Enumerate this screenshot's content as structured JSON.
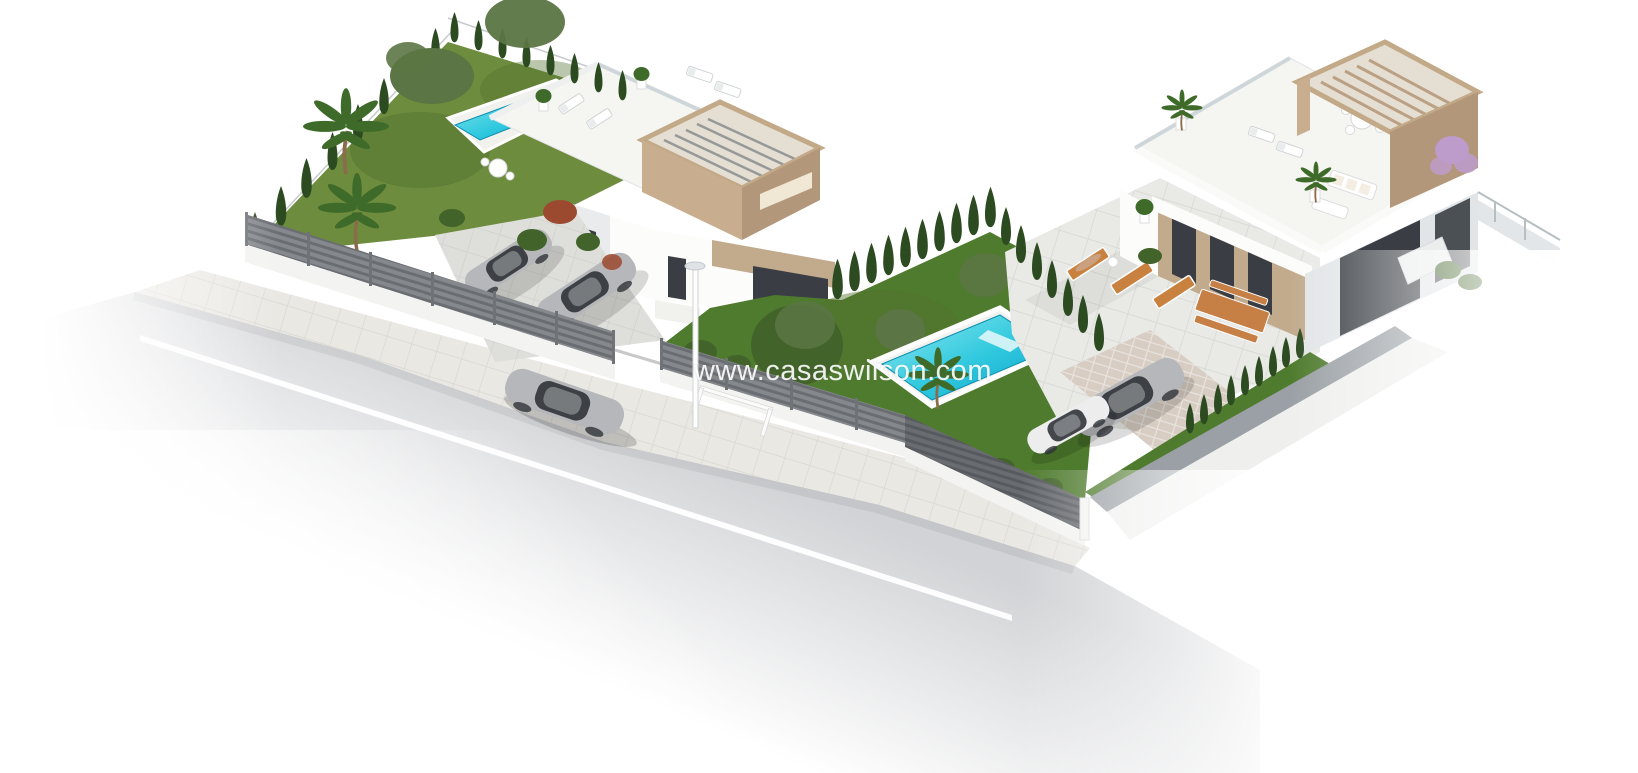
{
  "meta": {
    "type": "3d-architectural-render",
    "subject": "Aerial 3D render of two modern white villas with gardens, swimming pools, pergola roof terraces, parked cars and a street"
  },
  "watermark": {
    "text": "www.casaswilson.com"
  },
  "scene": {
    "left_villa": {
      "label": "left-villa-plot",
      "features": [
        "flat white roof terrace",
        "wood pergola tower",
        "narrow lap pool",
        "large lawn",
        "palm trees",
        "cypress hedge",
        "two parked silver cars",
        "grey slatted street fence"
      ]
    },
    "middle_garden": {
      "label": "garden-with-pool",
      "features": [
        "turquoise swimming pool",
        "lawn",
        "leafy trees",
        "palm tree",
        "cypress hedge"
      ]
    },
    "right_villa": {
      "label": "right-villa-plot",
      "features": [
        "roof terrace with white lounge furniture",
        "wood pergola",
        "paved patio",
        "orange sun loungers",
        "wooden picnic table",
        "driveway with silver and white car",
        "cypress hedges",
        "purple flowering tree"
      ]
    },
    "street": {
      "label": "street",
      "features": [
        "asphalt road",
        "white center line",
        "silver sedan",
        "street lamp",
        "tiled sidewalk"
      ]
    }
  },
  "colors": {
    "bg": "#ffffff",
    "road": "#d2d3d6",
    "road-line": "#ffffff",
    "sidewalk": "#eae8e3",
    "fence": "#85888c",
    "fence-dark": "#696c70",
    "fence-base": "#f3f3f2",
    "wall-gray": "#9aa0a5",
    "grass-left": "#6d8c3e",
    "grass-mid": "#4f7b2e",
    "grass-dark": "#54722f",
    "cypress": "#2d4b21",
    "tree-olive": "#5b7544",
    "tree-blob": "#426329",
    "palm-green": "#3f6b2a",
    "trunk-brown": "#8a6b4a",
    "bush-red": "#9c4a2f",
    "pool-light": "#8fe9f0",
    "pool-mid": "#2ec8de",
    "pool-deep": "#129ec9",
    "pool-deck": "#f1f1ee",
    "villa-white": "#fcfcfb",
    "villa-roof": "#f5f5f2",
    "villa-shade": "#e9ebec",
    "villa-side": "#e2e5e7",
    "window-dark": "#3a3e44",
    "pergola-top": "#e5dfd3",
    "pergola-frame": "#c2a987",
    "pergola-front": "#b3977a",
    "pergola-side": "#c8ae8e",
    "pergola-cut": "#f0e7d4",
    "tan-wall": "#c2ab8d",
    "car-silver": "#b6b7ba",
    "car-white": "#ededee",
    "car-glass": "#30343a",
    "lounger-orange": "#c8813f",
    "wood-brown": "#c67f45",
    "purple-tree": "#bd9bca",
    "lamp-white": "#fdfdfd",
    "watermark-color": "#ffffff"
  }
}
